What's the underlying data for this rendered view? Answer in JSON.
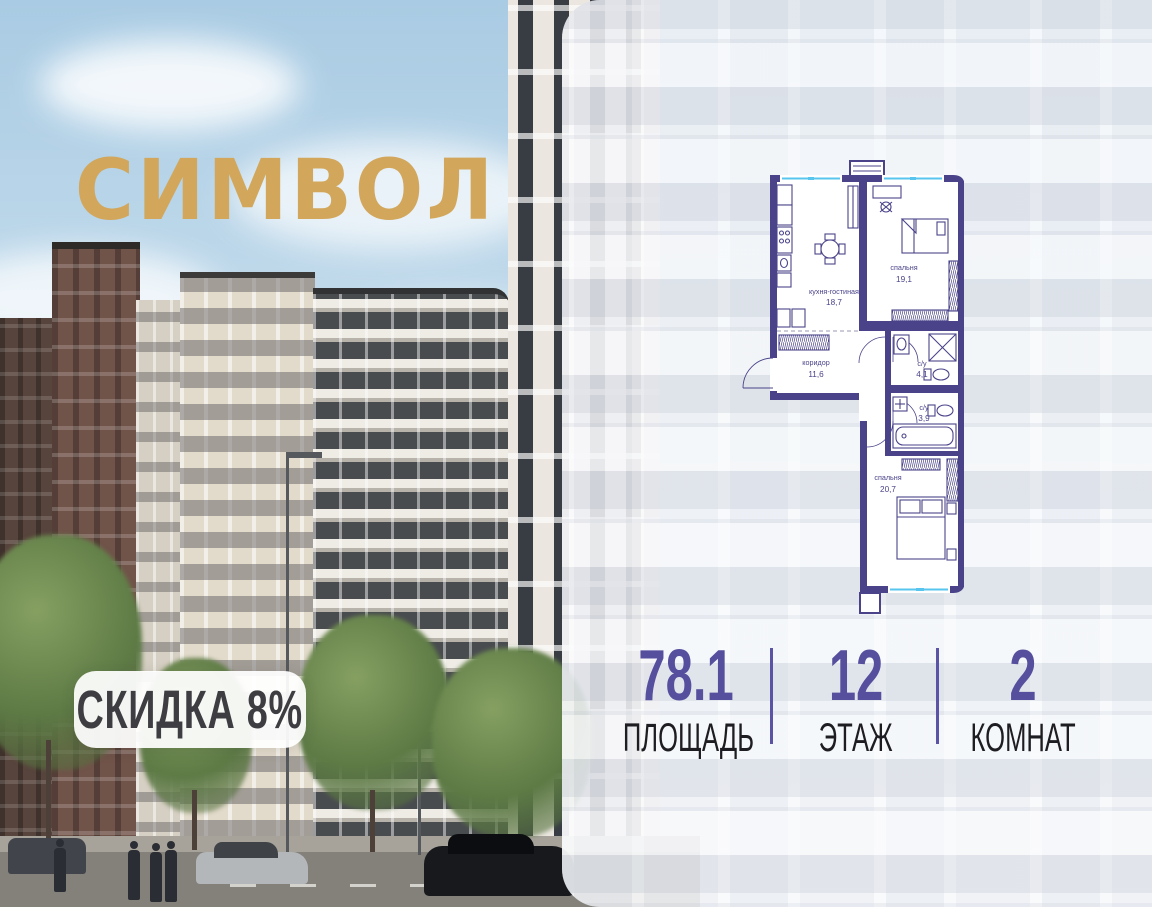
{
  "logo": {
    "text": "СИМВОЛ",
    "color": "#d2a75c"
  },
  "badge": {
    "label": "СКИДКА 8%"
  },
  "floor_plan": {
    "wall_color": "#4a4389",
    "window_color": "#57c5ee",
    "rooms": {
      "kitchen_living": {
        "name": "кухня-гостиная",
        "area": "18,7"
      },
      "bedroom_1": {
        "name": "спальня",
        "area": "19,1"
      },
      "corridor": {
        "name": "коридор",
        "area": "11,6"
      },
      "bathroom_1": {
        "name": "с/у",
        "area": "4,1"
      },
      "bathroom_2": {
        "name": "с/у",
        "area": "3,9"
      },
      "bedroom_2": {
        "name": "спальня",
        "area": "20,7"
      }
    }
  },
  "stats": {
    "accent_color": "#564f9e",
    "area": {
      "value": "78.1",
      "label": "ПЛОЩАДЬ"
    },
    "floor": {
      "value": "12",
      "label": "ЭТАЖ"
    },
    "rooms": {
      "value": "2",
      "label": "КОМНАТ"
    }
  }
}
